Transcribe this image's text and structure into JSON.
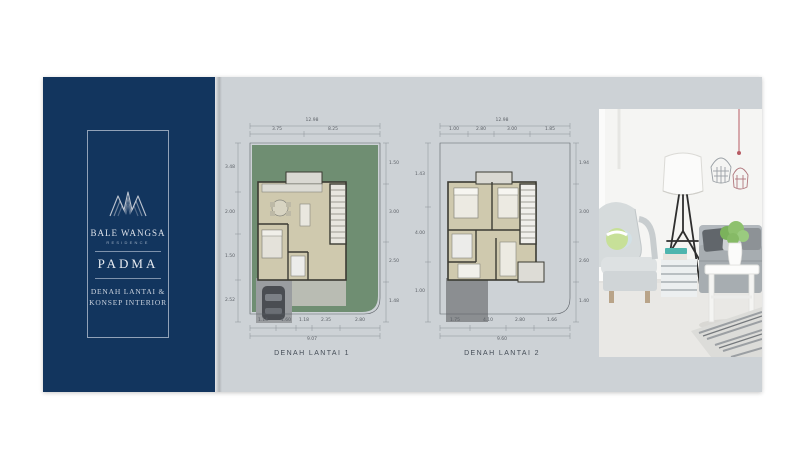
{
  "brand": {
    "name": "BALE WANGSA",
    "subtitle": "RESIDENCE",
    "product": "PADMA",
    "tagline_line1": "DENAH LANTAI &",
    "tagline_line2": "KONSEP INTERIOR"
  },
  "plans": [
    {
      "label": "DENAH LANTAI 1",
      "dims": {
        "top_total": "12.98",
        "top_subs": [
          "3.75",
          "8.25"
        ],
        "left_subs": [
          "3.48",
          "2.00",
          "1.50",
          "2.52"
        ],
        "right_subs": [
          "1.50",
          "3.00",
          "2.50",
          "1.48"
        ],
        "bottom_subs": [
          "1.14",
          "1.60",
          "1.18",
          "2.35",
          "2.80"
        ],
        "bottom_total": "9.07"
      }
    },
    {
      "label": "DENAH LANTAI 2",
      "dims": {
        "top_total": "12.98",
        "top_subs": [
          "1.00",
          "2.80",
          "3.00",
          "1.85"
        ],
        "left_subs": [
          "1.43",
          "4.00",
          "1.00"
        ],
        "right_subs": [
          "1.94",
          "3.00",
          "2.60",
          "1.40"
        ],
        "bottom_subs": [
          "1.75",
          "4.10",
          "2.80",
          "1.66"
        ],
        "bottom_total": "9.60"
      }
    }
  ],
  "colors": {
    "navy": "#12355e",
    "card_gray": "#cdd2d6",
    "garden_green": "#6f8e72",
    "floor_beige": "#cfc9ae",
    "wall_dark": "#3b3b33",
    "driveway_gray": "#9a9da0",
    "roof_gray": "#8b8e91"
  }
}
